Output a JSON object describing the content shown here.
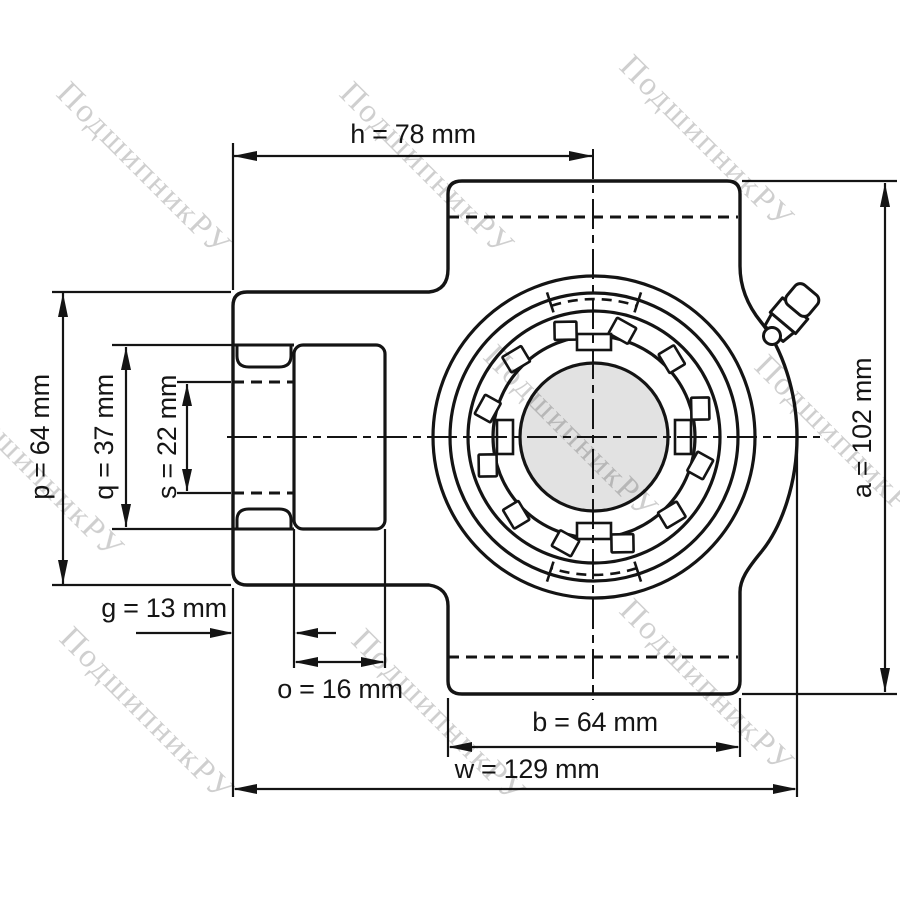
{
  "drawing": {
    "type": "technical-drawing",
    "subject": "take-up bearing unit, front view with shaft bore",
    "units": "mm"
  },
  "watermark": {
    "text": "ПодшипникРУ",
    "color": "#cfcfcf"
  },
  "dimensions": {
    "h": {
      "letter": "h",
      "value": 78,
      "unit": "mm",
      "label": "h = 78 mm"
    },
    "a": {
      "letter": "a",
      "value": 102,
      "unit": "mm",
      "label": "a = 102 mm"
    },
    "p": {
      "letter": "p",
      "value": 64,
      "unit": "mm",
      "label": "p = 64 mm"
    },
    "q": {
      "letter": "q",
      "value": 37,
      "unit": "mm",
      "label": "q = 37 mm"
    },
    "s": {
      "letter": "s",
      "value": 22,
      "unit": "mm",
      "label": "s = 22 mm"
    },
    "g": {
      "letter": "g",
      "value": 13,
      "unit": "mm",
      "label": "g = 13 mm"
    },
    "o": {
      "letter": "o",
      "value": 16,
      "unit": "mm",
      "label": "o = 16 mm"
    },
    "b": {
      "letter": "b",
      "value": 64,
      "unit": "mm",
      "label": "b = 64 mm"
    },
    "w": {
      "letter": "w",
      "value": 129,
      "unit": "mm",
      "label": "w = 129 mm"
    }
  },
  "colors": {
    "line": "#141414",
    "bore_fill": "#e2e2e2",
    "background": "#ffffff"
  }
}
